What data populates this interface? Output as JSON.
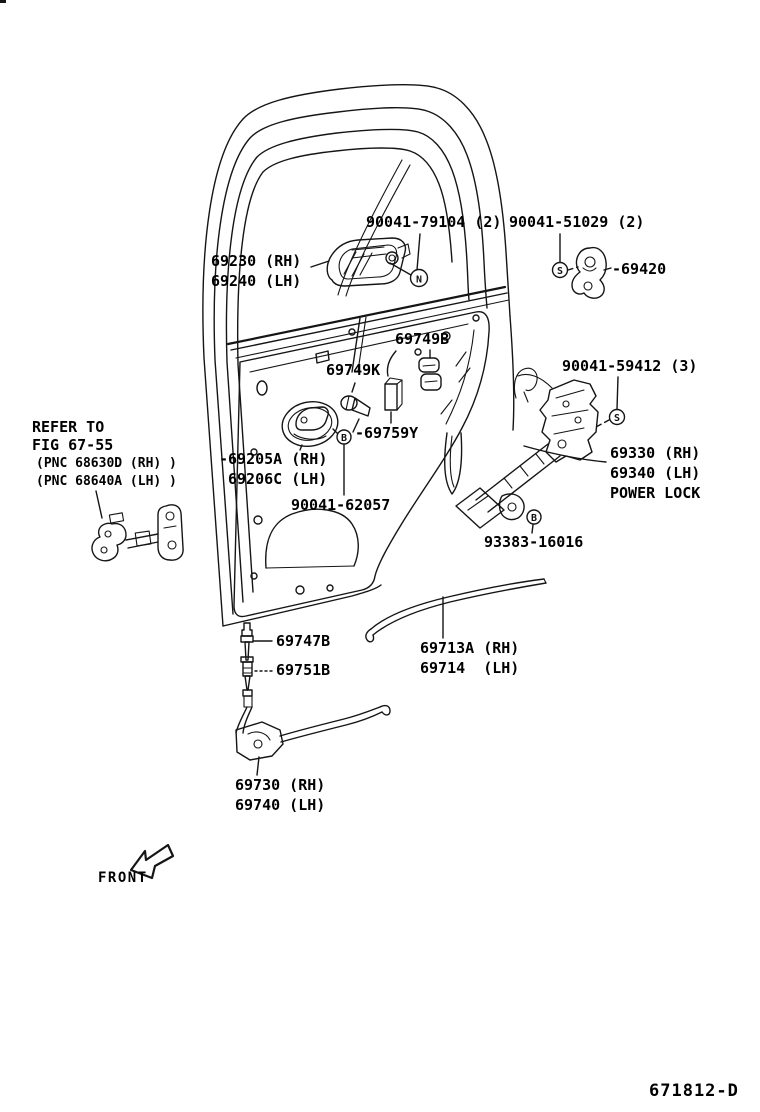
{
  "diagram": {
    "figure_code": "671812-D",
    "front_indicator": "FRONT",
    "note": {
      "line1": "REFER TO",
      "line2": "FIG 67-55",
      "line3": "(PNC 68630D (RH) )",
      "line4": "(PNC 68640A (LH) )"
    },
    "parts": {
      "outside_handle_rh": "69230 (RH)",
      "outside_handle_lh": "69240 (LH)",
      "outside_handle_nut": "90041-79104 (2)",
      "striker_screw": "90041-51029 (2)",
      "striker": "-69420",
      "clip_69749b": "69749B",
      "clip_69749k": "69749K",
      "lock_screw": "90041-59412 (3)",
      "inside_handle_rh": "-69205A (RH)",
      "inside_handle_lh": "69206C (LH)",
      "clip_69759y": "-69759Y",
      "inside_handle_bolt": "90041-62057",
      "lock_rh": "69330 (RH)",
      "lock_lh": "69340 (LH)",
      "lock_type": "POWER LOCK",
      "lock_bolt": "93383-16016",
      "clip_69747b": "69747B",
      "clip_69751b": "69751B",
      "lock_rod_rh": "69713A (RH)",
      "lock_rod_lh": "69714  (LH)",
      "lock_cable_rh": "69730 (RH)",
      "lock_cable_lh": "69740 (LH)"
    },
    "fastener_symbols": {
      "nut": "N",
      "screw": "S",
      "bolt": "B"
    }
  },
  "colors": {
    "line": "#151515",
    "watermark": "#c9c9c9"
  }
}
